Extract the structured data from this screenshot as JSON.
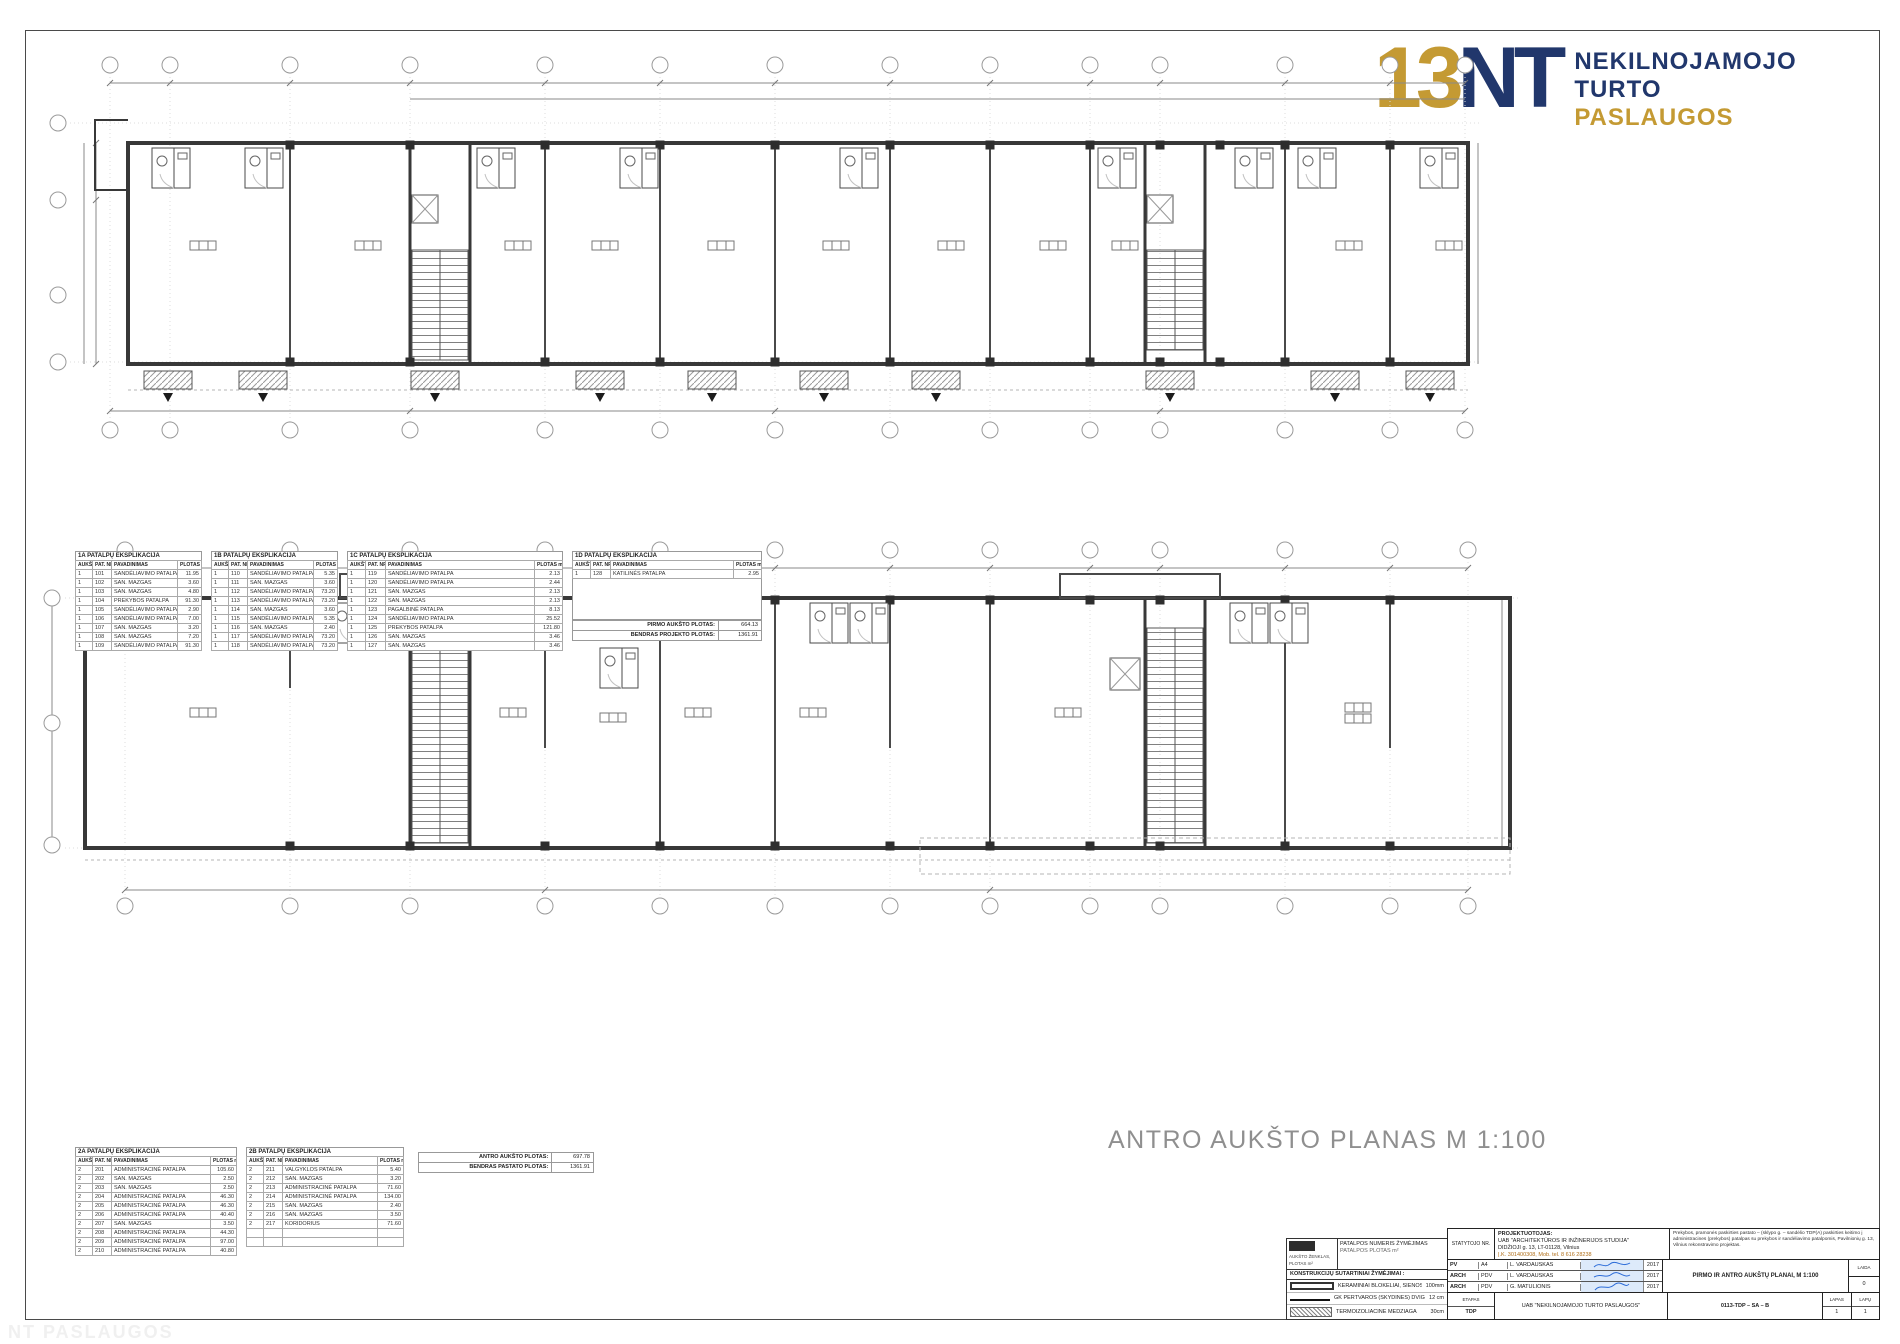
{
  "colors": {
    "gold": "#C49A33",
    "navy": "#21376C",
    "drawing": "#3c3c3c",
    "dim_gray": "#8a8a8a",
    "caption_gray": "#8f8f8f",
    "signature_blue": "#2b6bd8"
  },
  "logo": {
    "mark_number": "13",
    "mark_letters": "NT",
    "word1": "NEKILNOJAMOJO",
    "word2": "TURTO",
    "word3": "PASLAUGOS"
  },
  "plan2_caption": "ANTRO AUKŠTO PLANAS  M 1:100",
  "explication1": {
    "tables": [
      {
        "title": "1A PATALPŲ EKSPLIKACIJA",
        "headers": [
          "AUKŠT.",
          "PAT. NR.",
          "PAVADINIMAS",
          "PLOTAS m²"
        ],
        "rows": [
          [
            "1",
            "101",
            "SANDĖLIAVIMO PATALPA",
            "11.95"
          ],
          [
            "1",
            "102",
            "SAN. MAZGAS",
            "3.60"
          ],
          [
            "1",
            "103",
            "SAN. MAZGAS",
            "4.80"
          ],
          [
            "1",
            "104",
            "PREKYBOS PATALPA",
            "91.30"
          ],
          [
            "1",
            "105",
            "SANDĖLIAVIMO PATALPA",
            "2.90"
          ],
          [
            "1",
            "106",
            "SANDĖLIAVIMO PATALPA",
            "7.00"
          ],
          [
            "1",
            "107",
            "SAN. MAZGAS",
            "3.20"
          ],
          [
            "1",
            "108",
            "SAN. MAZGAS",
            "7.20"
          ],
          [
            "1",
            "109",
            "SANDĖLIAVIMO PATALPA",
            "91.30"
          ]
        ]
      },
      {
        "title": "1B PATALPŲ EKSPLIKACIJA",
        "headers": [
          "AUKŠT.",
          "PAT. NR.",
          "PAVADINIMAS",
          "PLOTAS m²"
        ],
        "rows": [
          [
            "1",
            "110",
            "SANDĖLIAVIMO PATALPA",
            "5.35"
          ],
          [
            "1",
            "111",
            "SAN. MAZGAS",
            "3.60"
          ],
          [
            "1",
            "112",
            "SANDĖLIAVIMO PATALPA",
            "73.20"
          ],
          [
            "1",
            "113",
            "SANDĖLIAVIMO PATALPA",
            "73.20"
          ],
          [
            "1",
            "114",
            "SAN. MAZGAS",
            "3.60"
          ],
          [
            "1",
            "115",
            "SANDĖLIAVIMO PATALPA",
            "5.35"
          ],
          [
            "1",
            "116",
            "SAN. MAZGAS",
            "2.40"
          ],
          [
            "1",
            "117",
            "SANDĖLIAVIMO PATALPA",
            "73.20"
          ],
          [
            "1",
            "118",
            "SANDĖLIAVIMO PATALPA",
            "73.20"
          ]
        ]
      },
      {
        "title": "1C PATALPŲ EKSPLIKACIJA",
        "headers": [
          "AUKŠT.",
          "PAT. NR.",
          "PAVADINIMAS",
          "PLOTAS m²"
        ],
        "rows": [
          [
            "1",
            "119",
            "SANDĖLIAVIMO PATALPA",
            "2.13"
          ],
          [
            "1",
            "120",
            "SANDĖLIAVIMO PATALPA",
            "2.44"
          ],
          [
            "1",
            "121",
            "SAN. MAZGAS",
            "2.13"
          ],
          [
            "1",
            "122",
            "SAN. MAZGAS",
            "2.13"
          ],
          [
            "1",
            "123",
            "PAGALBINĖ PATALPA",
            "8.13"
          ],
          [
            "1",
            "124",
            "SANDĖLIAVIMO PATALPA",
            "25.52"
          ],
          [
            "1",
            "125",
            "PREKYBOS PATALPA",
            "121.80"
          ],
          [
            "1",
            "126",
            "SAN. MAZGAS",
            "3.46"
          ],
          [
            "1",
            "127",
            "SAN. MAZGAS",
            "3.46"
          ]
        ]
      },
      {
        "title": "1D PATALPŲ EKSPLIKACIJA",
        "headers": [
          "AUKŠT.",
          "PAT. NR.",
          "PAVADINIMAS",
          "PLOTAS m²"
        ],
        "rows": [
          [
            "1",
            "128",
            "KATILINĖS PATALPA",
            "2.95"
          ]
        ]
      }
    ],
    "summary": [
      [
        "PIRMO AUKŠTO PLOTAS:",
        "664.13"
      ],
      [
        "BENDRAS PROJEKTO PLOTAS:",
        "1361.91"
      ]
    ]
  },
  "explication2": {
    "tables": [
      {
        "title": "2A PATALPŲ EKSPLIKACIJA",
        "headers": [
          "AUKŠT.",
          "PAT. NR.",
          "PAVADINIMAS",
          "PLOTAS m²"
        ],
        "rows": [
          [
            "2",
            "201",
            "ADMINISTRACINĖ PATALPA",
            "105.60"
          ],
          [
            "2",
            "202",
            "SAN. MAZGAS",
            "2.50"
          ],
          [
            "2",
            "203",
            "SAN. MAZGAS",
            "2.50"
          ],
          [
            "2",
            "204",
            "ADMINISTRACINĖ PATALPA",
            "46.30"
          ],
          [
            "2",
            "205",
            "ADMINISTRACINĖ PATALPA",
            "46.30"
          ],
          [
            "2",
            "206",
            "ADMINISTRACINĖ PATALPA",
            "40.40"
          ],
          [
            "2",
            "207",
            "SAN. MAZGAS",
            "3.50"
          ],
          [
            "2",
            "208",
            "ADMINISTRACINĖ PATALPA",
            "44.30"
          ],
          [
            "2",
            "209",
            "ADMINISTRACINĖ PATALPA",
            "97.00"
          ],
          [
            "2",
            "210",
            "ADMINISTRACINĖ PATALPA",
            "40.80"
          ]
        ]
      },
      {
        "title": "2B PATALPŲ EKSPLIKACIJA",
        "headers": [
          "AUKŠT.",
          "PAT. NR.",
          "PAVADINIMAS",
          "PLOTAS m²"
        ],
        "rows": [
          [
            "2",
            "211",
            "VALGYKLOS PATALPA",
            "5.40"
          ],
          [
            "2",
            "212",
            "SAN. MAZGAS",
            "3.20"
          ],
          [
            "2",
            "213",
            "ADMINISTRACINĖ PATALPA",
            "71.60"
          ],
          [
            "2",
            "214",
            "ADMINISTRACINĖ PATALPA",
            "134.00"
          ],
          [
            "2",
            "215",
            "SAN. MAZGAS",
            "2.40"
          ],
          [
            "2",
            "216",
            "SAN. MAZGAS",
            "3.50"
          ],
          [
            "2",
            "217",
            "KORIDORIUS",
            "71.60"
          ],
          [
            "",
            "",
            "",
            ""
          ],
          [
            "",
            "",
            "",
            ""
          ]
        ]
      }
    ],
    "summary": [
      [
        "ANTRO AUKŠTO PLOTAS:",
        "697.78"
      ],
      [
        "BENDRAS PASTATO PLOTAS:",
        "1361.91"
      ]
    ]
  },
  "legend": {
    "stamp_caption": "AUKŠTO ŽENKLAS, PLOTAS m²",
    "note_line1": "PATALPOS NUMERIS ŽYMĖJIMAS",
    "note_line2": "PATALPOS PLOTAS m²",
    "strip": "KONSTRUKCIJŲ SUTARTINIAI ŽYMĖJIMAI :",
    "rows": [
      [
        "KERAMINIAI BLOKELIAI, SIENOS",
        "100mm"
      ],
      [
        "GK PERTVAROS (SKYDINĖS) DVIGUBOS",
        "12 cm"
      ],
      [
        "TERMOIZOLIACINĖ MEDŽIAGA",
        "30cm"
      ]
    ]
  },
  "title_block": {
    "owner_no_label": "STATYTOJO NR.",
    "designer_label": "PROJEKTUOTOJAS:",
    "designer_line1": "UAB \"ARCHITEKTŪROS IR INŽINERIJOS STUDIJA\"",
    "designer_line2": "DIDŽIOJI g. 13, LT-01128, Vilnius",
    "designer_line3": "Į.K. 301400308, Mob. tel. 8 616 28238",
    "object_text": "Prekybos, pramonės paskirties pastato – (sklypo g. – sandėlio TDP(A) paskirties keitimo į administracines (prekybos) patalpas su prekybos ir sandėliavimo patalpomis, Pavilnionių g. 13, Vilnius rekonstravimo projektas.",
    "sig_rows": [
      {
        "role": "PV",
        "cert": "A4",
        "name": "L. VARDAUSKAS",
        "date": "2017"
      },
      {
        "role": "ARCH",
        "cert": "PDV",
        "name": "L. VARDAUSKAS",
        "date": "2017"
      },
      {
        "role": "ARCH",
        "cert": "PDV",
        "name": "G. MATULIONIS",
        "date": "2017"
      }
    ],
    "drawing_title": "PIRMO IR ANTRO AUKŠTŲ PLANAI, M 1:100",
    "laida_label": "LAIDA",
    "laida_value": "0",
    "etapas_label": "ETAPAS",
    "etapas_value": "TDP",
    "client": "UAB \"NEKILNOJAMOJO TURTO PASLAUGOS\"",
    "doc_no": "0113-TDP – SA – B",
    "lapas_label": "LAPAS",
    "lapas_value": "1",
    "lapu_label": "LAPŲ",
    "lapu_value": "1"
  },
  "watermark": "NT PASLAUGOS"
}
